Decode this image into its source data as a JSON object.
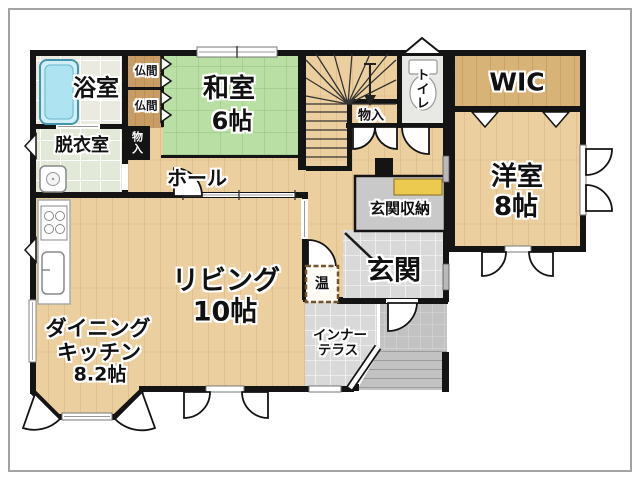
{
  "rooms": {
    "bathroom": "浴室",
    "butsuma1": "仏間",
    "butsuma2": "仏間",
    "washitsu_name": "和室",
    "washitsu_size": "6帖",
    "datsui": "脱衣室",
    "storage_left": "物入",
    "hall": "ホール",
    "storage_stairs": "物入",
    "toilet": "トイレ",
    "wic": "WIC",
    "youshitsu_name": "洋室",
    "youshitsu_size": "8帖",
    "genkan_storage": "玄関収納",
    "genkan": "玄関",
    "living_name": "リビング",
    "living_size": "10帖",
    "dk_line1": "ダイニング",
    "dk_line2": "キッチン",
    "dk_size": "8.2帖",
    "terrace_line1": "インナー",
    "terrace_line2": "テラス",
    "water_heater": "温"
  },
  "colors": {
    "wall": "#141414",
    "wood_floor": "#eccf9f",
    "wic_floor": "#d8b377",
    "tatami": "#badfa5",
    "tile": "#dadada",
    "shelf_yellow": "#ecc94f",
    "bathtub_blue": "#aee4f2"
  }
}
